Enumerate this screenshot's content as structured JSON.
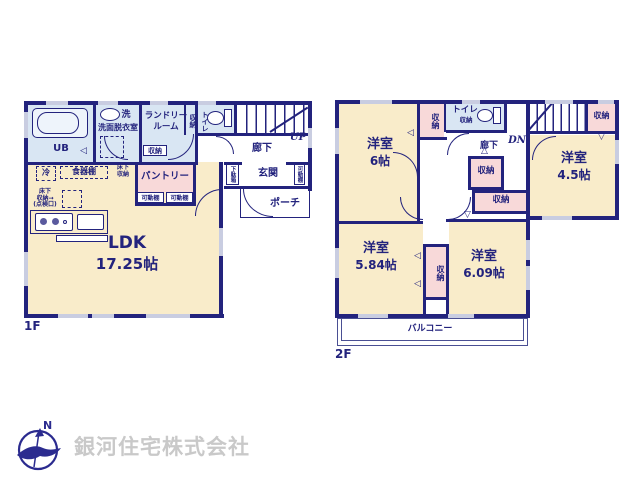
{
  "colors": {
    "wall_navy": "#23237d",
    "room_cream": "#f9ecca",
    "wet_area_blue": "#d9e6f3",
    "closet_pink": "#f8d9d9",
    "window_lavender": "#c9cde1",
    "company_gray": "#c9c9c9"
  },
  "common": {
    "storage": "収納",
    "hallway": "廊下",
    "toilet": "トイレ",
    "movable_shelf": "可動棚",
    "western_room": "洋室"
  },
  "floor1": {
    "label": "1F",
    "up": "UP",
    "ub": "UB",
    "washer": "洗",
    "washroom": "洗面脱衣室",
    "laundry_line1": "ランドリー",
    "laundry_line2": "ルーム",
    "fridge": "冷",
    "cupboard": "食器棚",
    "underfloor": "床下\n収納",
    "underfloor_hatch": "床下\n収納→\n(点検口)",
    "pantry": "パントリー",
    "shoe_cabinet": "下駄箱",
    "entrance": "玄関",
    "porch": "ポーチ",
    "ldk": "LDK",
    "ldk_size": "17.25帖"
  },
  "floor2": {
    "label": "2F",
    "dn": "DN",
    "room6_size": "6帖",
    "room45_size": "4.5帖",
    "room584_size": "5.84帖",
    "room609_size": "6.09帖",
    "balcony": "バルコニー"
  },
  "footer": {
    "company": "銀河住宅株式会社",
    "compass_n": "N"
  }
}
